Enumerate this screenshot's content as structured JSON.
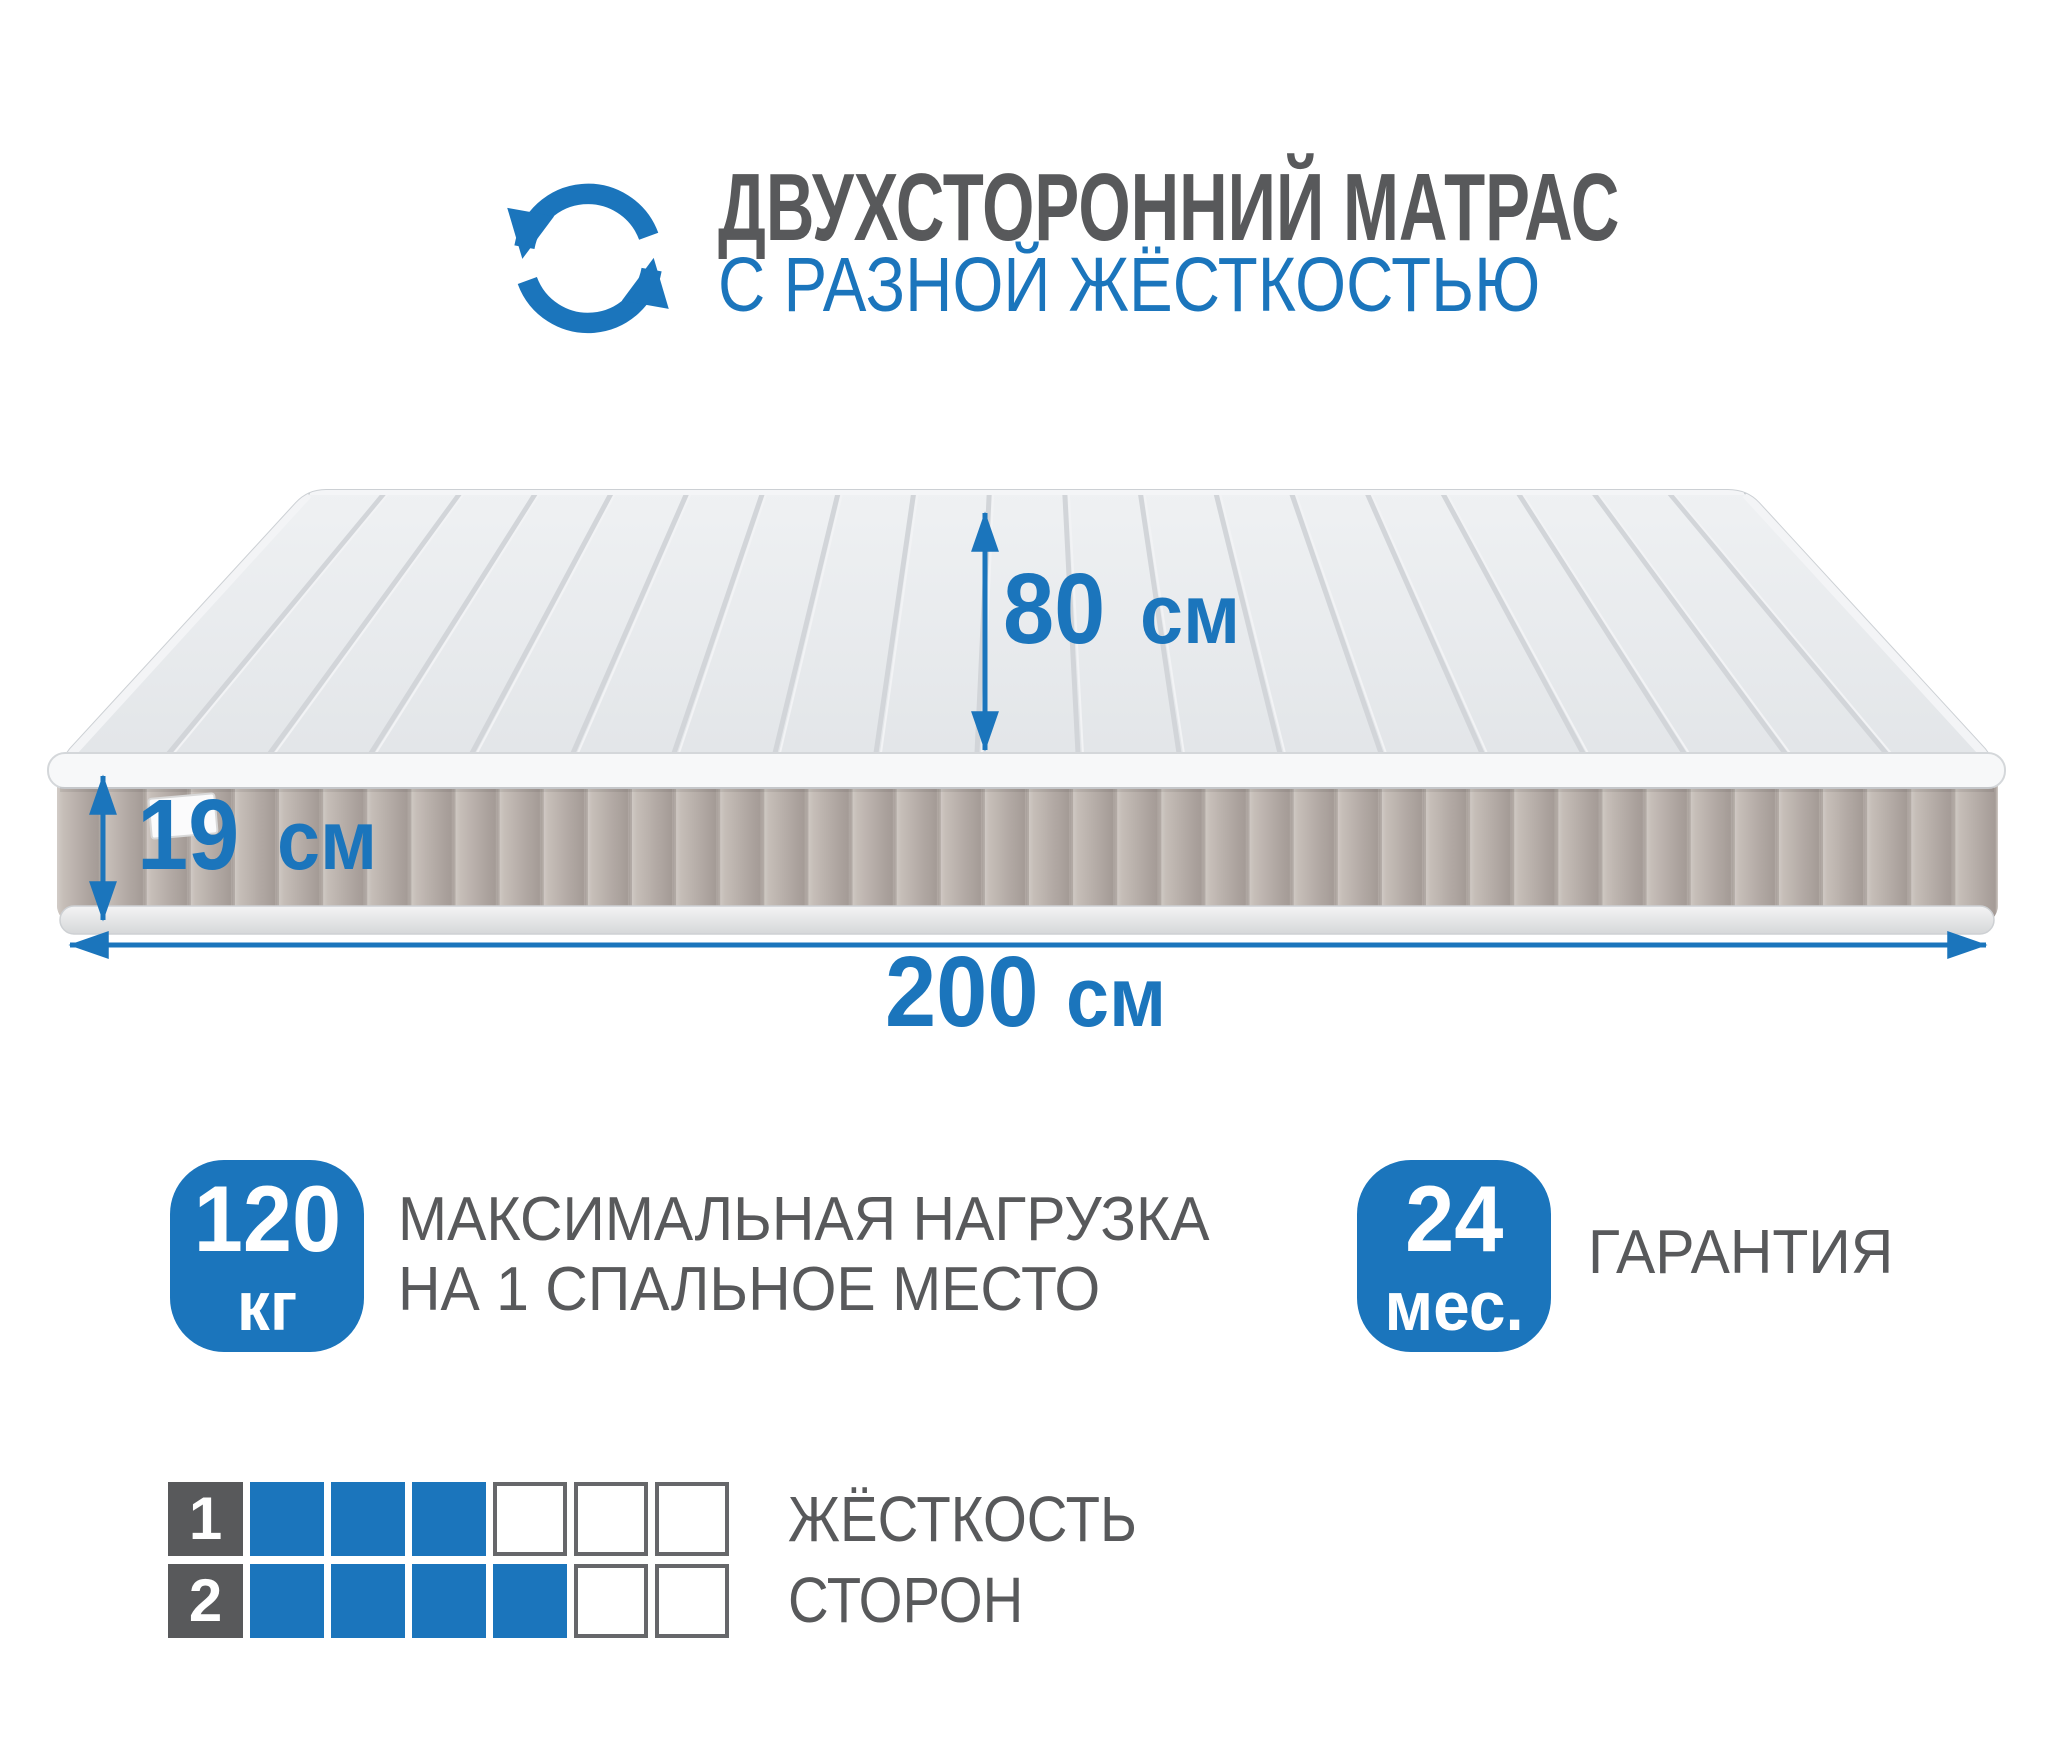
{
  "colors": {
    "accent_blue": "#1b75bc",
    "text_gray": "#58595b",
    "mattress_top": "#e6e8ea",
    "mattress_side": "#b5aca7"
  },
  "header": {
    "icon": "rotate-arrows-icon",
    "title_line1": "ДВУХСТОРОННИЙ МАТРАС",
    "subtitle_line2": "С РАЗНОЙ ЖЁСТКОСТЬЮ"
  },
  "dimensions": {
    "width": {
      "value": "80",
      "unit": "см"
    },
    "height": {
      "value": "19",
      "unit": "см"
    },
    "length": {
      "value": "200",
      "unit": "см"
    }
  },
  "badges": {
    "max_load": {
      "value": "120",
      "unit": "кг",
      "label_line1": "МАКСИМАЛЬНАЯ НАГРУЗКА",
      "label_line2": "НА 1 СПАЛЬНОЕ МЕСТО"
    },
    "warranty": {
      "value": "24",
      "unit": "мес.",
      "label": "ГАРАНТИЯ"
    }
  },
  "firmness_scale": {
    "label_line1": "ЖЁСТКОСТЬ",
    "label_line2": "СТОРОН",
    "cells_total": 6,
    "rows": [
      {
        "side": "1",
        "filled": 3
      },
      {
        "side": "2",
        "filled": 4
      }
    ]
  }
}
